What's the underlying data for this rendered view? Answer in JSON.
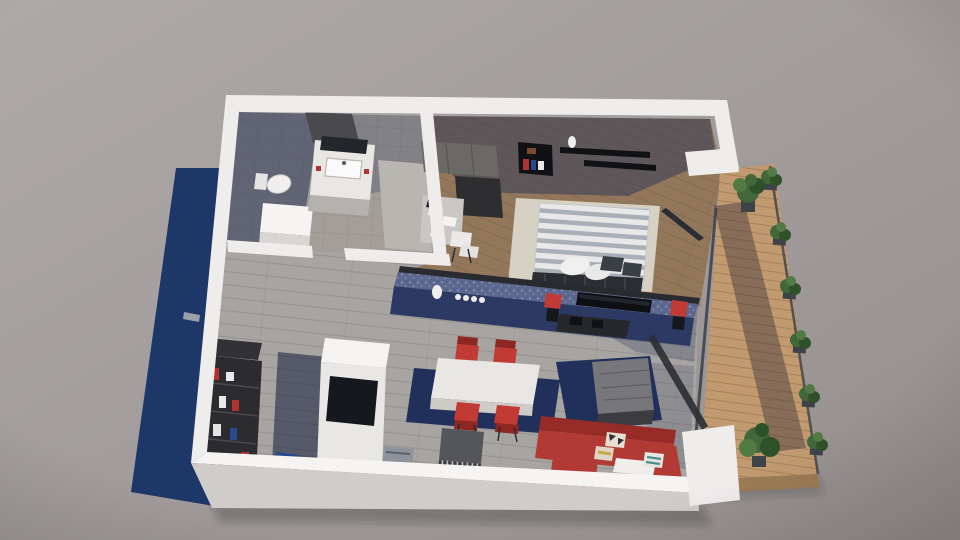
{
  "scene": {
    "label": "3D isometric render of an apartment floor plan viewed from above",
    "rooms": [
      {
        "name": "bathroom",
        "items": [
          "vanity-sink",
          "mirror",
          "toilet",
          "shower-tray",
          "storage-cabinet"
        ]
      },
      {
        "name": "entry-hall",
        "items": [
          "bookshelf",
          "blue-door-mat",
          "entry-door-handle"
        ]
      },
      {
        "name": "kitchen",
        "items": [
          "tall-white-unit",
          "glass-oven-panel",
          "steel-appliance",
          "white-island",
          "bar-counter",
          "bottles",
          "bar-stools"
        ]
      },
      {
        "name": "dining-area",
        "items": [
          "white-table",
          "red-chairs",
          "navy-rug",
          "gray-sideboard"
        ]
      },
      {
        "name": "living-room",
        "items": [
          "red-corner-sofa",
          "patterned-pillows",
          "cube-coffee-table",
          "navy-rug",
          "wall-tv",
          "tv-console",
          "glass-wall"
        ]
      },
      {
        "name": "bedroom",
        "items": [
          "double-bed-striped-duvet",
          "pillows",
          "cream-rug",
          "red-nightstand",
          "wardrobe",
          "desk-with-papers",
          "white-chair",
          "box-shelf-with-books",
          "floating-shelves",
          "vase"
        ]
      },
      {
        "name": "balcony",
        "items": [
          "wood-deck",
          "railing",
          "planter-boxes",
          "large-plants"
        ]
      }
    ],
    "counts": {
      "dining_chairs": 4,
      "bar_stools": 2,
      "planter_boxes": 6,
      "bottles_on_bar": 5,
      "sofa_pillows": 3,
      "bed_pillows": 4
    },
    "lighting": "sunlight from lower-left casting blue shadow band along left wall and diagonal shadows on balcony deck"
  },
  "palette": {
    "backdrop_light": "#aca7a7",
    "backdrop_dark": "#958f8e",
    "shadow_navy": "#1d3769",
    "wall_white": "#efedec",
    "wall_bright": "#f6f4f3",
    "wall_face_light": "#cfccc9",
    "wall_face_dark": "#b3afac",
    "interior_shadow": "#2c3558",
    "hall_shadow": "#131c3c",
    "tile_floor": "#a39e98",
    "tile_line": "#8f8a84",
    "plank_floor": "#a7a4a1",
    "plank_line": "#8b8885",
    "wood_floor": "#93775b",
    "wood_line": "#7a6249",
    "deck_wood": "#c19a6f",
    "deck_line": "#8d6f4e",
    "deck_shadow": "#2f2838",
    "rug_navy": "#20305a",
    "rug_cream": "#d6d1c2",
    "bar_top": "#5d6890",
    "bar_face": "#2c3a63",
    "dark_counter": "#2a2b30",
    "charcoal": "#26272b",
    "black": "#101114",
    "tv_black": "#0e0f12",
    "sofa_red": "#b23a35",
    "sofa_red_dark": "#962b28",
    "chair_red": "#c13a33",
    "chair_red_dark": "#8e2723",
    "accent_red": "#b03331",
    "white_furn": "#e9e7e4",
    "steel": "#8d939b",
    "mirror": "#23262b",
    "gray_furn": "#55565a",
    "table_top": "#77767a",
    "wardrobe_top": "#6b6965",
    "wardrobe_dark": "#2e2e31",
    "bed_white": "#e8e8e8",
    "bed_stripe": "#a9afb8",
    "pillow_dark": "#3a3e45",
    "pillow_cream": "#e5dfd2",
    "pillow_tan": "#ded6c4",
    "pillow_yellow": "#c9a84c",
    "pillow_teal": "#4f8f8a",
    "plant_green": "#41673a",
    "plant_dark": "#2f5129",
    "plant_light": "#527a45",
    "planter_box": "#3f4246",
    "glass_frame": "#3a3f49",
    "blue_mat": "#274a8c",
    "desk_top": "#c9c7c3",
    "paper_white": "#f4f3f1"
  }
}
